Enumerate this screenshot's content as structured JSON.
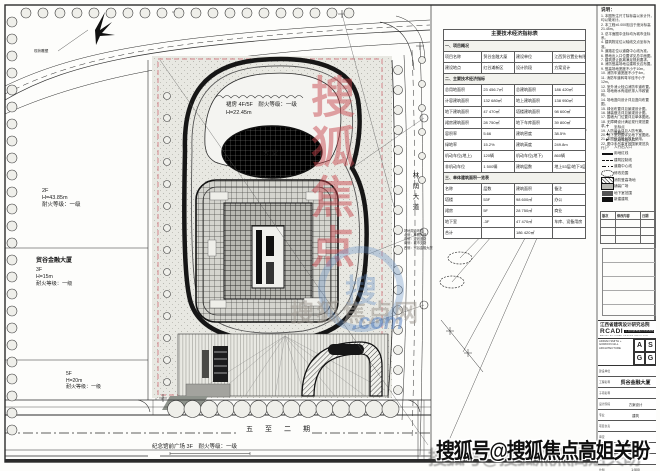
{
  "plan": {
    "sculpture_label": "现状雕塑",
    "parcel_a": {
      "l1": "2F",
      "l2": "H=43.85m",
      "l3": "耐火等级：一级"
    },
    "parcel_b": {
      "name": "贸谷金融大厦",
      "l1": "3F",
      "l2": "H=15m",
      "l3": "耐火等级：一级"
    },
    "parcel_c": {
      "l1": "5F",
      "l2": "H=20m",
      "l3": "耐火等级：一级"
    },
    "podium": {
      "l1": "裙房 4F/5F　耐火等级：一级",
      "l2": "H=22.45m"
    },
    "lobby": "大堂",
    "road_right": "林荫大道",
    "road_bottom": "五至二期",
    "plaza_label": "纪念馆前广场 3F　耐火等级：一级",
    "side_note": [
      "场地周边环境：",
      "北侧：林荫大道",
      "东侧：规划道路",
      "南侧：城市支路",
      "西侧：贸谷金融大厦"
    ]
  },
  "table": {
    "rows": [
      {
        "t": "主要技术经济指标表"
      },
      {
        "s": "一、项目概况"
      },
      {
        "c": [
          "项目名称",
          "贸谷金融大厦",
          "建设单位",
          "江西贸谷置业有限公司"
        ]
      },
      {
        "c": [
          "建设地点",
          "红谷滩新区",
          "设计阶段",
          "方案设计"
        ]
      },
      {
        "s": "二、主要技术经济指标"
      },
      {
        "c": [
          "总用地面积",
          "23 456.7㎡",
          "总建筑面积",
          "186 420㎡"
        ]
      },
      {
        "c": [
          "计容建筑面积",
          "132 680㎡",
          "地上建筑面积",
          "138 950㎡"
        ]
      },
      {
        "c": [
          "地下建筑面积",
          "47 470㎡",
          "塔楼建筑面积",
          "98 600㎡"
        ]
      },
      {
        "c": [
          "裙房建筑面积",
          "28 750㎡",
          "地下车库面积",
          "39 800㎡"
        ]
      },
      {
        "c": [
          "容积率",
          "5.66",
          "建筑密度",
          "38.5%"
        ]
      },
      {
        "c": [
          "绿地率",
          "15.2%",
          "建筑高度",
          "249.8m"
        ]
      },
      {
        "c": [
          "机动车位(地上)",
          "120辆",
          "机动车位(地下)",
          "860辆"
        ]
      },
      {
        "c": [
          "非机动车位",
          "1 500辆",
          "建筑层数",
          "地上53层/地下3层"
        ]
      },
      {
        "s": "三、单体建筑面积一览表"
      },
      {
        "c": [
          "名称",
          "层数",
          "建筑面积",
          "备注"
        ]
      },
      {
        "c": [
          "塔楼",
          "53F",
          "98 600㎡",
          "办公"
        ]
      },
      {
        "c": [
          "裙房",
          "5F",
          "28 750㎡",
          "商业"
        ]
      },
      {
        "c": [
          "地下室",
          "-3F",
          "47 470㎡",
          "车库、设备用房"
        ]
      },
      {
        "c": [
          "合计",
          "",
          "186 420㎡",
          ""
        ]
      }
    ]
  },
  "notes": {
    "title": "说明：",
    "lines": [
      "1. 本图所注尺寸除标高以米计外，均以毫米计。",
      "2. 本工程±0.000相当于绝对标高21.45m。",
      "3. 总平面图中坐标均为城市坐标系。",
      "4. 建筑物定位以轴线交点坐标为准。",
      "5. 道路定位以道路中心线为准。",
      "6. 基地出入口位置详见总平面图。",
      "7. 建筑退让距离满足规划要求。",
      "8. 消防登高场地沿建筑长边布置。",
      "9. 登高场地宽度不小于10m。",
      "10. 消防车道宽度不小于4m。",
      "11. 消防车道转弯半径不小于12m。",
      "12. 室外消火栓沿消防车道布置。",
      "13. 场地雨水有组织排入市政管网。",
      "14. 场地竖向设计详见竖向布置图。",
      "15. 绿化布置详见景观设计图。",
      "16. 铺装做法详见景观设计图。",
      "17. 围墙大门位置详见单体图纸。",
      "18. 无障碍设计满足现行规范要求。",
      "19. 人防设计详见人防专篇。",
      "20. 地下室范围详见地下室图纸。",
      "21. 本图仅供规划报批使用。",
      "22. 图中未尽事宜按国家规范执行。"
    ]
  },
  "legend": {
    "items": [
      {
        "sym": "cross",
        "label": "坐标点"
      },
      {
        "sym": "tri",
        "label": "高程点"
      },
      {
        "sym": "arrf",
        "label": "机动车出入口"
      },
      {
        "sym": "arro",
        "label": "人行出入口"
      },
      {
        "sym": "linet",
        "label": "用地红线"
      },
      {
        "sym": "lined",
        "label": "建筑控制线"
      },
      {
        "sym": "linedd",
        "label": "道路中心线"
      },
      {
        "sym": "cloud",
        "label": "修改范围"
      },
      {
        "sym": "hatch",
        "label": "消防登高场地"
      },
      {
        "sym": "gray",
        "label": "铺装广场"
      },
      {
        "sym": "dark",
        "label": "地下室范围"
      },
      {
        "sym": "black",
        "label": "新建建筑"
      }
    ]
  },
  "rev_table": {
    "headers": [
      "版次",
      "修改内容",
      "日期"
    ]
  },
  "titleblock": {
    "brand_cn": "江西省建筑设计研究总院",
    "brand_abbr": "RCADI",
    "brand_chip": "江西省建筑设计研究总院集团股份有限公司",
    "brand_sub": "ARCHITECTURAL DESIGN INSTITUTE",
    "asgg_lines": [
      "ADRIAN SMITH +",
      "GORDON GILL",
      "ARCHITECTURE"
    ],
    "asgg_letters": [
      "A",
      "S",
      "G",
      "G"
    ],
    "rows": [
      {
        "label": "建设单位",
        "value": "",
        "cls": ""
      },
      {
        "label": "工程名称",
        "value": "贸谷金融大厦",
        "cls": "proj"
      },
      {
        "label": "子项名称",
        "value": "",
        "cls": ""
      },
      {
        "label": "设计阶段",
        "value": "方案设计",
        "cls": ""
      },
      {
        "label": "专业",
        "value": "建筑",
        "cls": ""
      },
      {
        "label": "项目负责",
        "value": "",
        "cls": ""
      },
      {
        "label": "审定",
        "value": "",
        "cls": ""
      },
      {
        "label": "图名",
        "value": "总平面图",
        "cls": "dwg"
      },
      {
        "label": "图号",
        "value": "",
        "cls": ""
      },
      {
        "label": "比例",
        "value": "1:500",
        "cls": ""
      }
    ]
  },
  "watermark": {
    "bottom_text": "搜狐号@搜狐焦点高姐关盼",
    "red_vertical": "搜狐焦点",
    "ring_char": "搜",
    "gray_text": "搜狐焦点网",
    "blue_text": ".com"
  }
}
